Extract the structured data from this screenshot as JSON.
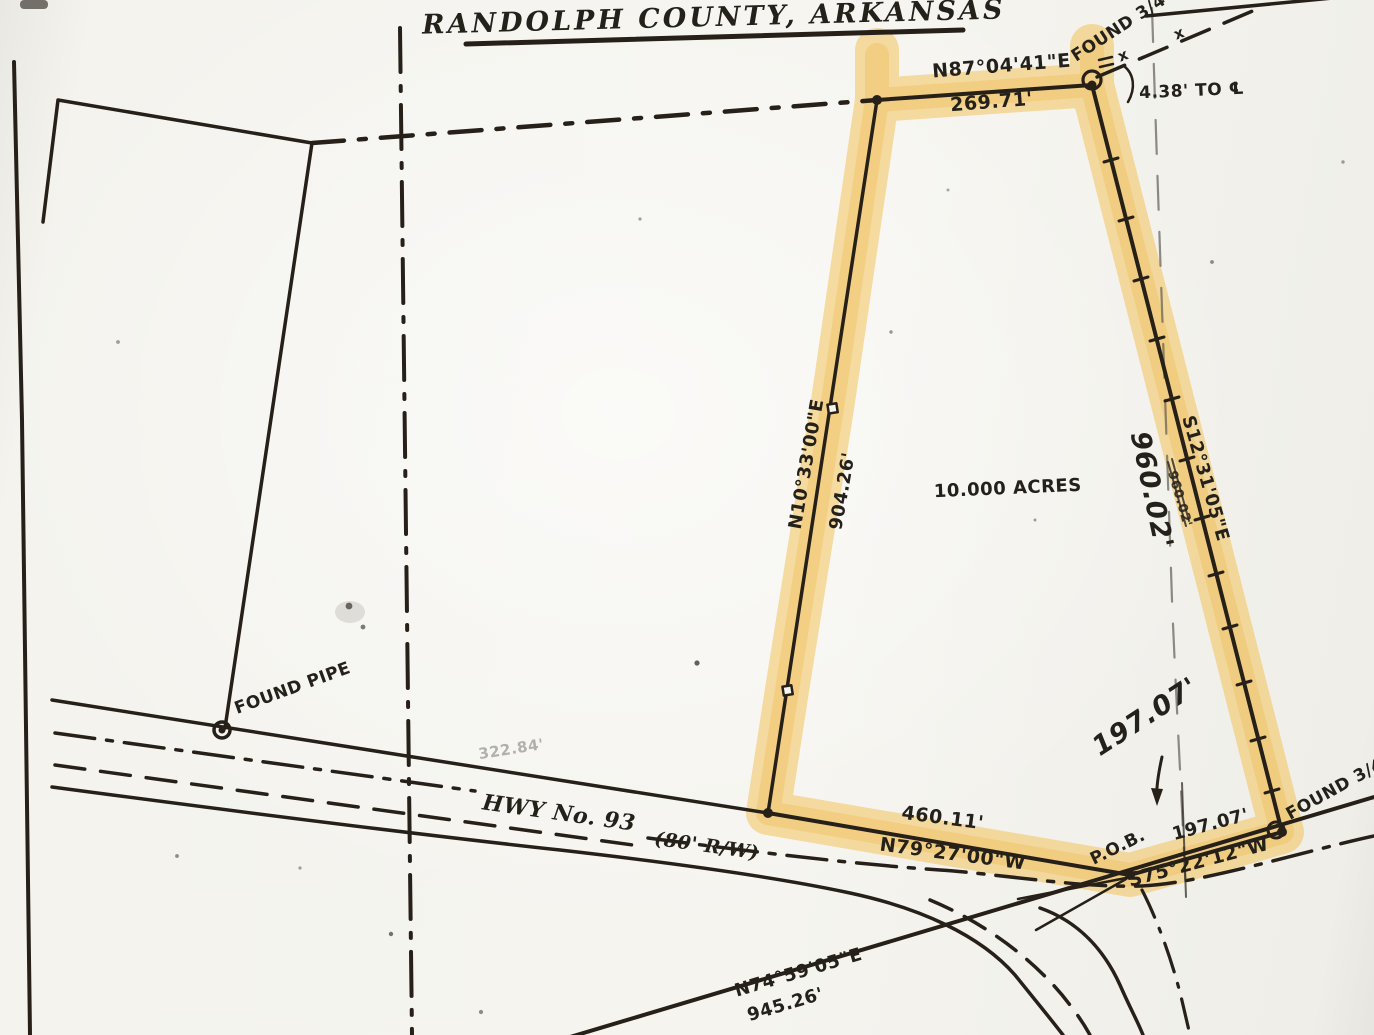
{
  "map": {
    "title": "RANDOLPH COUNTY, ARKANSAS",
    "parcel": {
      "area": "10.000 ACRES",
      "pob": "P.O.B.",
      "courses": {
        "north": {
          "bearing": "N87°04'41\"E",
          "distance": "269.71'"
        },
        "west": {
          "bearing": "N10°33'00\"E",
          "distance": "904.26'"
        },
        "east": {
          "bearing": "S12°31'05\"E",
          "distance_printed": "960.02'",
          "distance_handwritten": "960.02'"
        },
        "south": {
          "bearing": "N79°27'00\"W",
          "distance": "460.11'"
        },
        "southeast": {
          "bearing": "S75°22'12\"W",
          "distance": "197.07'",
          "distance_handwritten": "197.07'"
        }
      }
    },
    "monuments": {
      "found_pipe": "FOUND PIPE",
      "found_rebar_north": "FOUND 3/4\"",
      "found_rebar_south": "FOUND 3/4\" S",
      "tie_note": "4.38' TO ℄"
    },
    "highway": {
      "name": "HWY No. 93",
      "right_of_way": "(80' R/W)",
      "south_line_bearing": "N74°59'05\"E",
      "south_line_distance": "945.26'"
    },
    "misc": {
      "faint_distance": "322.84'",
      "fence_mark": "x"
    },
    "colors": {
      "highlighter": "#f2bd45",
      "ink": "#262019",
      "paper": "#f5f4ef"
    }
  }
}
